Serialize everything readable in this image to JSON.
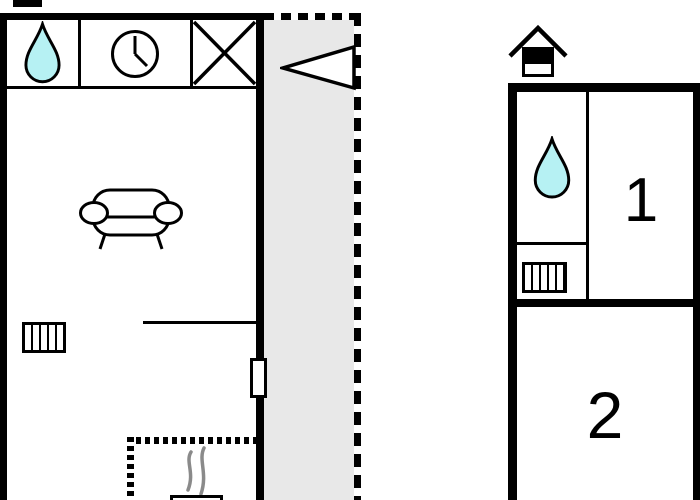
{
  "document": {
    "type": "floor-plan",
    "floors": [
      {
        "id": "ground-floor",
        "description": "Main floor with living area, terrace and fireplace",
        "icons": [
          "water-drop",
          "clock",
          "window-cross",
          "entrance-arrow",
          "sofa",
          "radiator",
          "door",
          "fireplace-hatch",
          "steam",
          "stove"
        ],
        "rooms": []
      },
      {
        "id": "upper-floor",
        "description": "Upper floor with two numbered rooms",
        "icons": [
          "upper-floor-house",
          "water-drop",
          "radiator"
        ],
        "rooms": [
          {
            "number": "1"
          },
          {
            "number": "2"
          }
        ]
      }
    ]
  },
  "colors": {
    "wall": "#000000",
    "water_fill": "#b6f1f3",
    "terrace_fill": "#e8e8e8",
    "steam": "#8a8a8a",
    "paper": "#ffffff"
  }
}
